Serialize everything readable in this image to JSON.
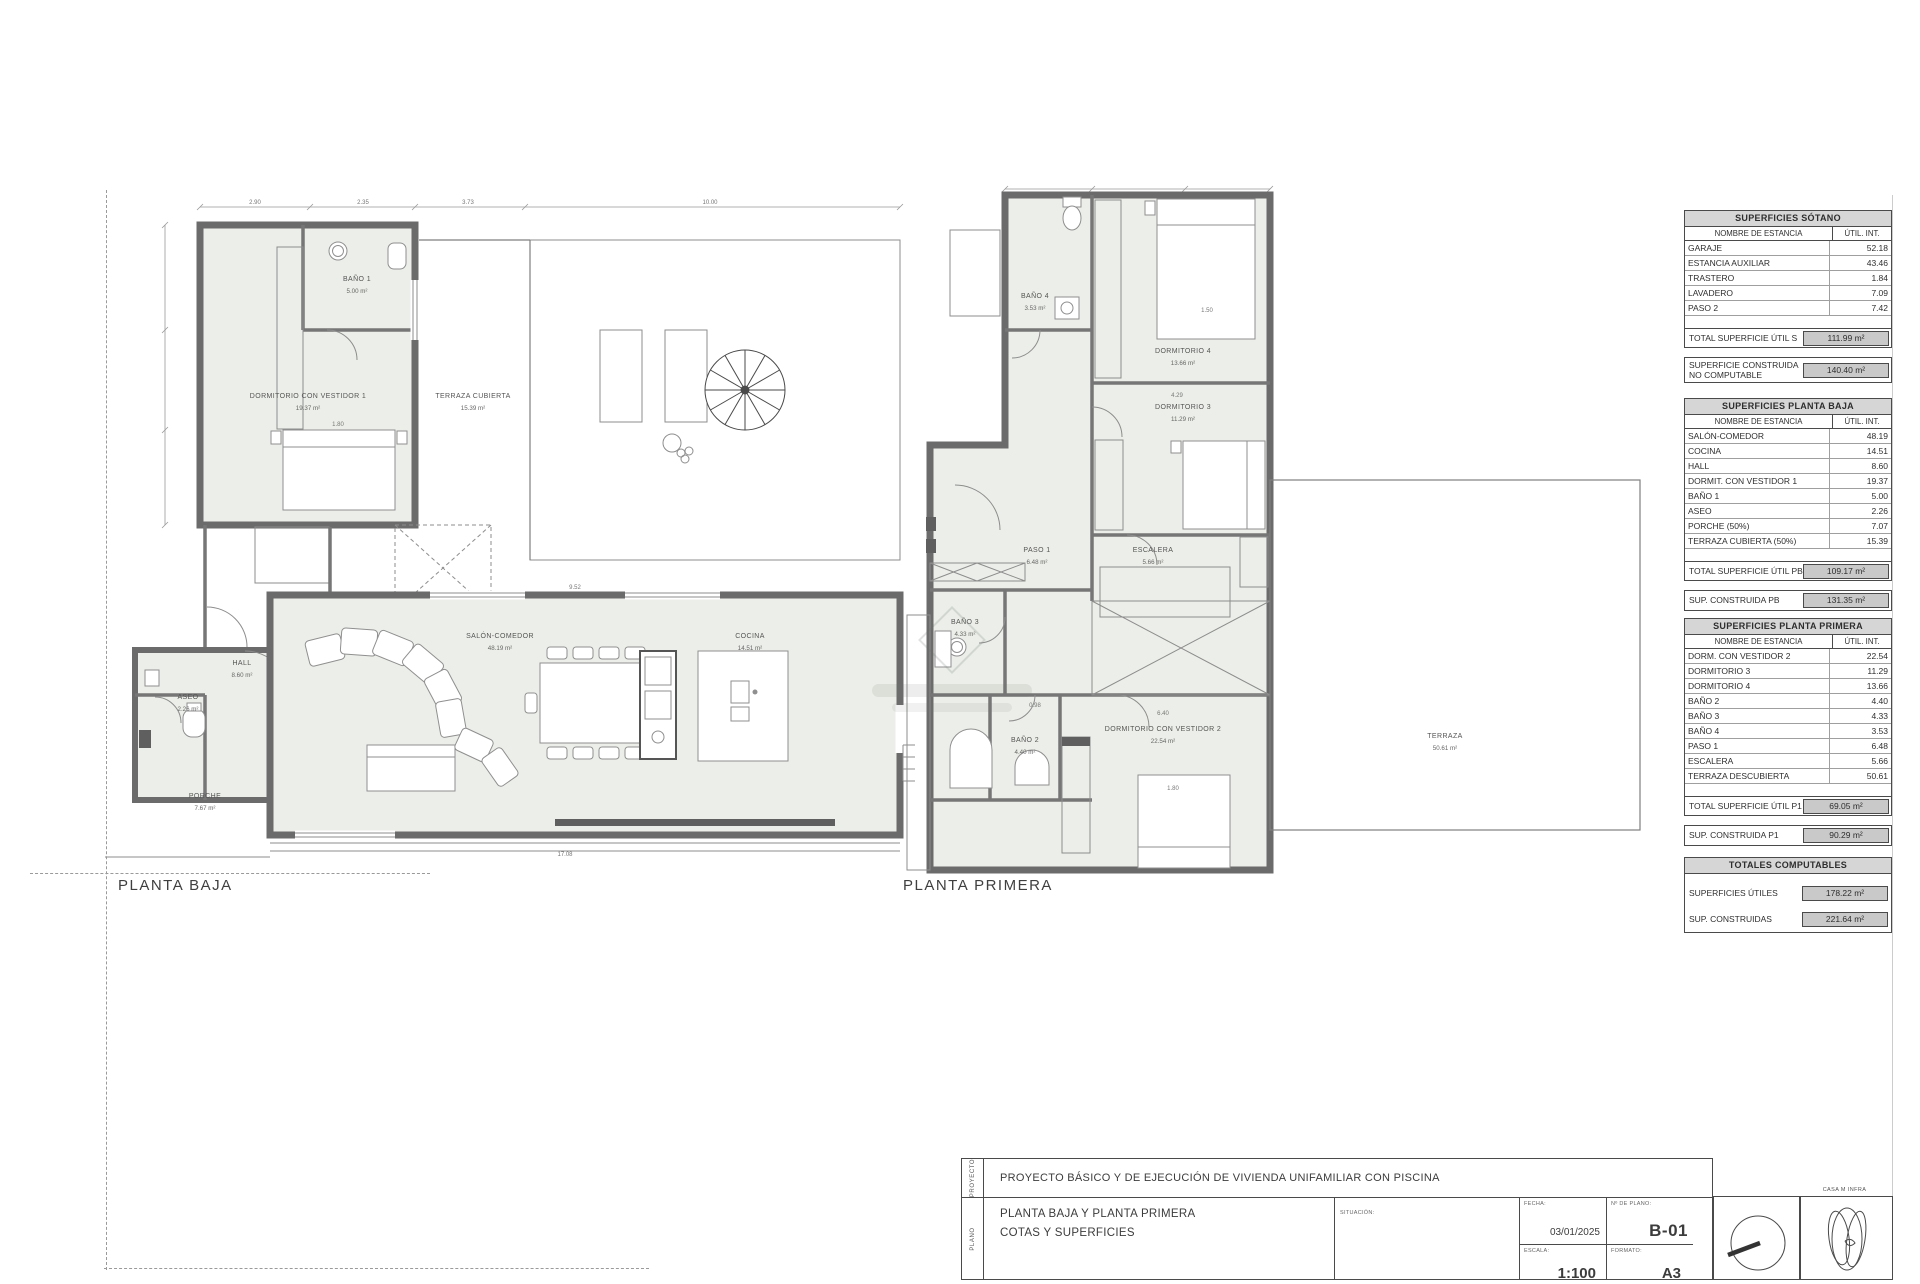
{
  "plans": {
    "baja": {
      "caption": "PLANTA BAJA",
      "rooms": [
        {
          "name": "BAÑO 1",
          "area": "5.00 m²"
        },
        {
          "name": "DORMITORIO CON VESTIDOR 1",
          "area": "19.37 m²"
        },
        {
          "name": "TERRAZA CUBIERTA",
          "area": "15.39 m²"
        },
        {
          "name": "HALL",
          "area": "8.60 m²"
        },
        {
          "name": "ASEO",
          "area": "2.26 m²"
        },
        {
          "name": "SALÓN-COMEDOR",
          "area": "48.19 m²"
        },
        {
          "name": "COCINA",
          "area": "14.51 m²"
        },
        {
          "name": "PORCHE",
          "area": "7.67 m²"
        }
      ],
      "dims": [
        "2.90",
        "2.35",
        "3.73",
        "10.00",
        "1.80",
        "9.52",
        "7.87",
        "17.08"
      ]
    },
    "primera": {
      "caption": "PLANTA PRIMERA",
      "rooms": [
        {
          "name": "BAÑO 4",
          "area": "3.53 m²"
        },
        {
          "name": "DORMITORIO 4",
          "area": "13.66 m²"
        },
        {
          "name": "DORMITORIO 3",
          "area": "11.29 m²"
        },
        {
          "name": "PASO 1",
          "area": "6.48 m²"
        },
        {
          "name": "ESCALERA",
          "area": "5.66 m²"
        },
        {
          "name": "BAÑO 3",
          "area": "4.33 m²"
        },
        {
          "name": "BAÑO 2",
          "area": "4.40 m²"
        },
        {
          "name": "DORMITORIO CON VESTIDOR 2",
          "area": "22.54 m²"
        },
        {
          "name": "TERRAZA",
          "area": "50.61 m²"
        }
      ],
      "dims": [
        "4.29",
        "1.50",
        "6.40",
        "0.98",
        "1.80"
      ]
    }
  },
  "tables": {
    "sotano": {
      "title": "SUPERFICIES SÓTANO",
      "col_name": "NOMBRE DE ESTANCIA",
      "col_val": "ÚTIL. INT.",
      "rows": [
        {
          "name": "GARAJE",
          "val": "52.18"
        },
        {
          "name": "ESTANCIA AUXILIAR",
          "val": "43.46"
        },
        {
          "name": "TRASTERO",
          "val": "1.84"
        },
        {
          "name": "LAVADERO",
          "val": "7.09"
        },
        {
          "name": "PASO 2",
          "val": "7.42"
        }
      ],
      "total_label": "TOTAL SUPERFICIE ÚTIL S",
      "total_val": "111.99 m²",
      "built_label": "SUPERFICIE CONSTRUIDA NO COMPUTABLE",
      "built_val": "140.40 m²"
    },
    "planta_baja": {
      "title": "SUPERFICIES  PLANTA BAJA",
      "col_name": "NOMBRE DE ESTANCIA",
      "col_val": "ÚTIL. INT.",
      "rows": [
        {
          "name": "SALÓN-COMEDOR",
          "val": "48.19"
        },
        {
          "name": "COCINA",
          "val": "14.51"
        },
        {
          "name": "HALL",
          "val": "8.60"
        },
        {
          "name": "DORMIT. CON VESTIDOR 1",
          "val": "19.37"
        },
        {
          "name": "BAÑO 1",
          "val": "5.00"
        },
        {
          "name": "ASEO",
          "val": "2.26"
        },
        {
          "name": "PORCHE (50%)",
          "val": "7.07"
        },
        {
          "name": "TERRAZA CUBIERTA (50%)",
          "val": "15.39"
        }
      ],
      "total_label": "TOTAL SUPERFICIE ÚTIL PB",
      "total_val": "109.17 m²",
      "built_label": "SUP. CONSTRUIDA PB",
      "built_val": "131.35 m²"
    },
    "planta_primera": {
      "title": "SUPERFICIES PLANTA PRIMERA",
      "col_name": "NOMBRE DE ESTANCIA",
      "col_val": "ÚTIL. INT.",
      "rows": [
        {
          "name": "DORM. CON VESTIDOR 2",
          "val": "22.54"
        },
        {
          "name": "DORMITORIO 3",
          "val": "11.29"
        },
        {
          "name": "DORMITORIO 4",
          "val": "13.66"
        },
        {
          "name": "BAÑO 2",
          "val": "4.40"
        },
        {
          "name": "BAÑO 3",
          "val": "4.33"
        },
        {
          "name": "BAÑO 4",
          "val": "3.53"
        },
        {
          "name": "PASO 1",
          "val": "6.48"
        },
        {
          "name": "ESCALERA",
          "val": "5.66"
        },
        {
          "name": "TERRAZA DESCUBIERTA",
          "val": "50.61"
        }
      ],
      "total_label": "TOTAL SUPERFICIE ÚTIL P1",
      "total_val": "69.05 m²",
      "built_label": "SUP. CONSTRUIDA P1",
      "built_val": "90.29 m²"
    },
    "totales": {
      "title": "TOTALES COMPUTABLES",
      "rows": [
        {
          "name": "SUPERFICIES ÚTILES",
          "val": "178.22 m²"
        },
        {
          "name": "SUP. CONSTRUIDAS",
          "val": "221.64 m²"
        }
      ]
    }
  },
  "titleblock": {
    "proyecto_label": "PROYECTO",
    "plano_label": "PLANO",
    "project_title": "PROYECTO BÁSICO Y DE EJECUCIÓN DE  VIVIENDA UNIFAMILIAR CON PISCINA",
    "plan_title_line1": "PLANTA BAJA Y PLANTA PRIMERA",
    "plan_title_line2": "COTAS Y SUPERFICIES",
    "situacion_label": "SITUACIÓN:",
    "fecha_label": "FECHA:",
    "fecha_value": "03/01/2025",
    "plano_num_label": "Nº DE PLANO:",
    "plano_num_value": "B-01",
    "escala_label": "ESCALA:",
    "escala_value": "1:100",
    "formato_label": "FORMATO:",
    "formato_value": "A3",
    "stamp_caption": "CASA M INFRA"
  }
}
